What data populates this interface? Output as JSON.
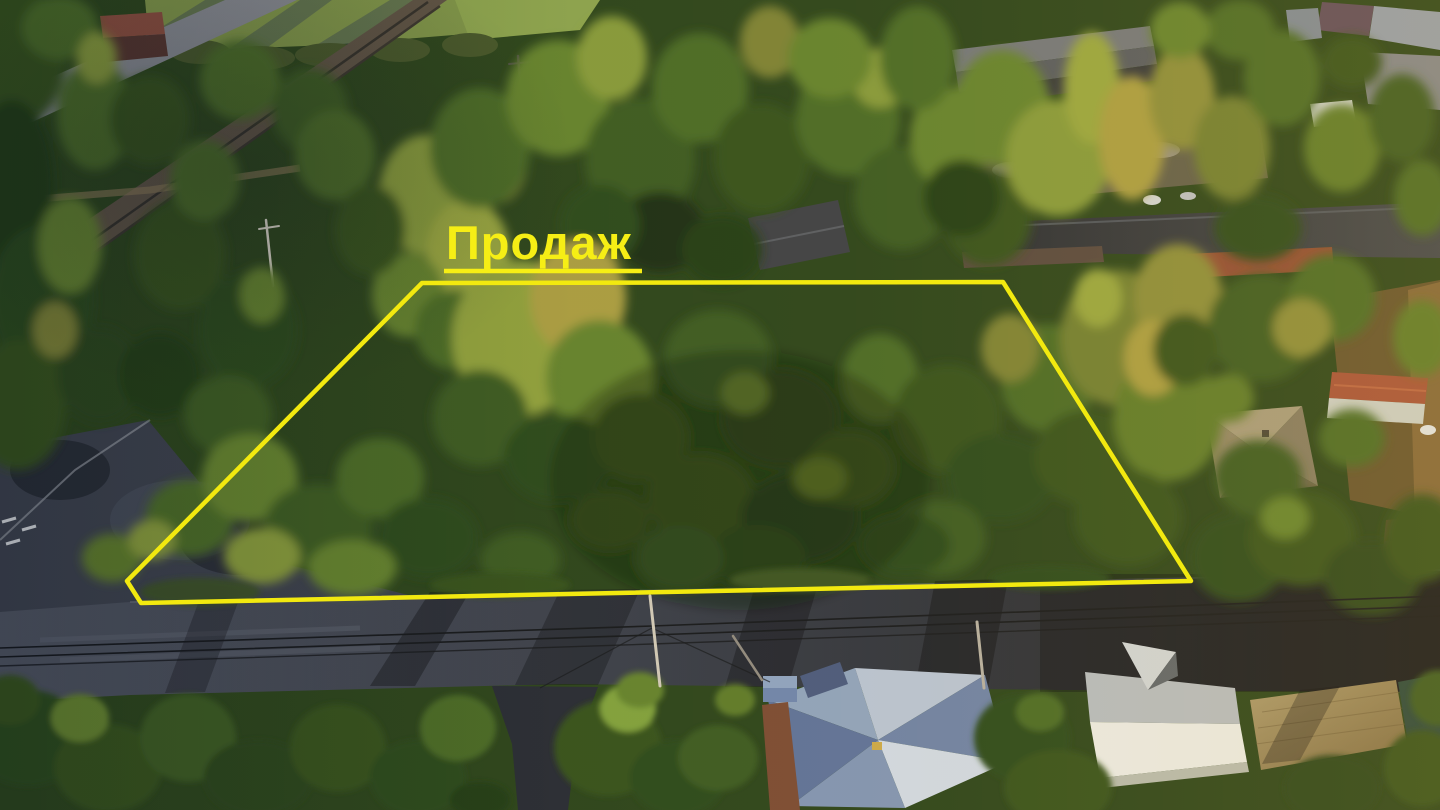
{
  "annotation": {
    "label": "Продаж",
    "label_color": "#f6ee15",
    "outline_color": "#f2e90f",
    "polygon_points": "422,283 1003,282 1191,581 141,603 127,581"
  },
  "palette": {
    "accent_yellow": "#f2e90f",
    "canopy_dark_green": "#2c4a1e",
    "canopy_sunlit_green": "#85993a",
    "canopy_golden": "#a89c42",
    "road_shadow_gray": "#23262e",
    "road_lit_gray": "#4e5360",
    "field_green": "#7e9448",
    "warm_light": "#ffc346"
  }
}
